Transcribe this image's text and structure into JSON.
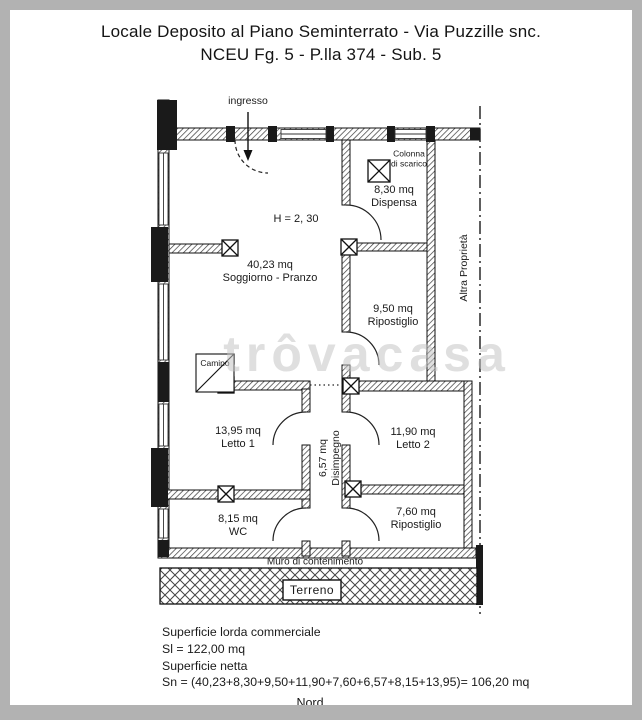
{
  "frame": {
    "border_color": "#b2b2b2",
    "page_color": "#ffffff"
  },
  "title": {
    "line1": "Locale Deposito al Piano Seminterrato - Via Puzzille snc.",
    "line2": "NCEU Fg. 5 - P.lla 374 - Sub. 5"
  },
  "watermark": {
    "text": "trôvacasa"
  },
  "plan": {
    "ink_color": "#1a1a1a",
    "entrance_label": "ingresso",
    "height_note": "H = 2, 30",
    "rooms": [
      {
        "area": "40,23 mq",
        "name": "Soggiorno - Pranzo"
      },
      {
        "area": "8,30 mq",
        "name": "Dispensa"
      },
      {
        "area": "9,50 mq",
        "name": "Ripostiglio"
      },
      {
        "area": "11,90 mq",
        "name": "Letto 2"
      },
      {
        "area": "13,95 mq",
        "name": "Letto 1"
      },
      {
        "area": "6,57 mq",
        "name": "Disimpegno"
      },
      {
        "area": "8,15 mq",
        "name": "WC"
      },
      {
        "area": "7,60 mq",
        "name": "Ripostiglio"
      }
    ],
    "annotations": {
      "colonna_line1": "Colonna",
      "colonna_line2": "di scarico",
      "camino": "Camino",
      "altra_proprieta": "Altra Proprietà",
      "muro_contenimento": "Muro di contenimento",
      "terreno": "Terreno"
    }
  },
  "summary": {
    "lorda_label": "Superficie lorda commerciale",
    "lorda_value": "Sl = 122,00 mq",
    "netta_label": "Superficie netta",
    "netta_value": "Sn = (40,23+8,30+9,50+11,90+7,60+6,57+8,15+13,95)= 106,20 mq",
    "compass": "Nord"
  }
}
